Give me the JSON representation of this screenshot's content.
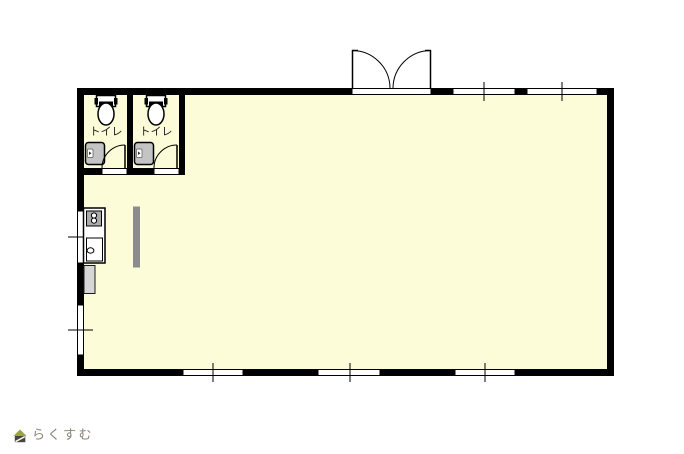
{
  "floorplan": {
    "room_fill": "#FCFCD8",
    "wall_color": "#000000",
    "toilet_rooms": [
      {
        "label": "トイレ"
      },
      {
        "label": "トイレ"
      }
    ],
    "fixtures": {
      "sink_gray": "#C4C4C4",
      "stove_gray": "#ABABAB",
      "appliance_gray": "#D6D6D6",
      "partition_gray": "#8C8C8C"
    },
    "icons": {
      "toilet": "toilet-icon",
      "toilet_hand_sink": "sink-icon",
      "stove": "stove-icon",
      "kitchen_sink": "kitchen-sink-icon",
      "door_swing": "door-swing-arc",
      "window": "window-pane"
    }
  },
  "logo": {
    "text": "らくすむ",
    "text_color": "#8B8275",
    "icon_roof_color": "#97A73C",
    "icon_base_color": "#4B443E"
  }
}
